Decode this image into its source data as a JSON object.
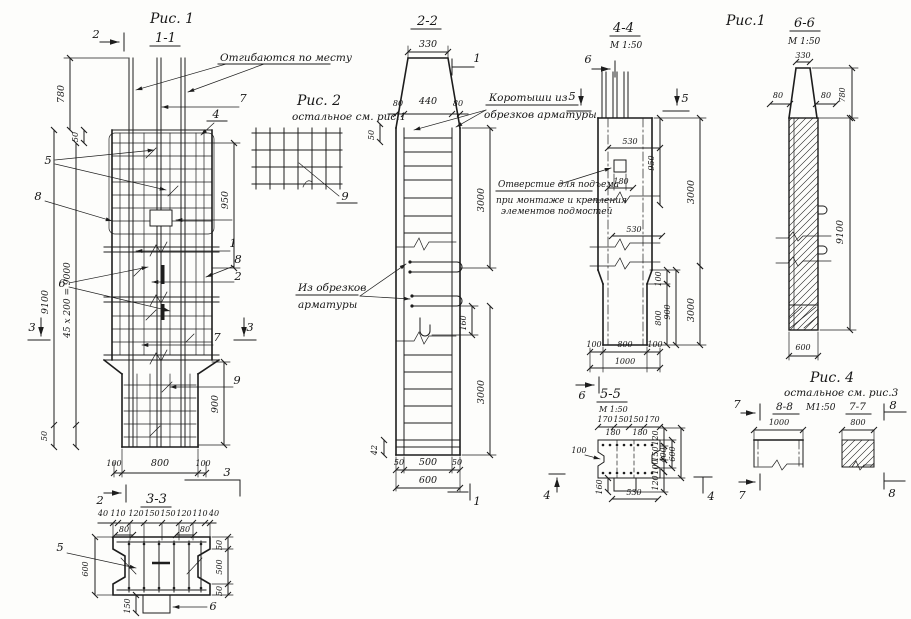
{
  "page": {
    "bg": "#fdfdfb",
    "ink": "#1d1d1d"
  },
  "fig1": {
    "title": "Рис. 1",
    "section": "1-1",
    "m2_top": "2",
    "m2_bottom": "2",
    "note_bend": "Отгибаются по месту",
    "d780": "780",
    "d50_top": "50",
    "d950": "950",
    "d9100": "9100",
    "d45x200": "45 х 200 = 9000",
    "d900": "900",
    "d50_bot": "50",
    "d100l": "100",
    "d800": "800",
    "d100r": "100",
    "c5": "5",
    "c8_left": "8",
    "c6": "6",
    "c1": "1",
    "c8_right": "8",
    "c2_right": "2",
    "c3_left": "3",
    "c3_right": "3",
    "c7_top": "7",
    "c4_top": "4",
    "c7_mid": "7",
    "c9": "9",
    "c3_bottom": "3"
  },
  "fig2": {
    "title": "Рис. 2",
    "subtitle": "остальное см. рис.1",
    "c9": "9"
  },
  "sec22": {
    "title": "2-2",
    "d330": "330",
    "m1_top": "1",
    "d80l": "80",
    "d440": "440",
    "d80r": "80",
    "d50side": "50",
    "note_korotyshi_1": "Коротыши  из",
    "note_korotyshi_2": "обрезков арматуры",
    "d3000a": "3000",
    "d160": "160",
    "d3000b": "3000",
    "note_obrezki_1": "Из обрезков",
    "note_obrezki_2": "арматуры",
    "d42": "42",
    "d50l": "50",
    "d500": "500",
    "d50r": "50",
    "d600": "600",
    "m1_bottom": "1"
  },
  "sec44": {
    "title": "4-4",
    "scale": "М 1:50",
    "fig_label": "Рис.1",
    "m6_top": "6",
    "m5_left": "5",
    "m5_right": "5",
    "d530a": "530",
    "d950": "950",
    "d3000a": "3000",
    "d180": "180",
    "d530b": "530",
    "note_hole_1": "Отверстие для подъема",
    "note_hole_2": "при монтаже и крепления",
    "note_hole_3": "элементов подмостей",
    "d100c": "100",
    "d800v": "800",
    "d900": "900",
    "d3000b": "3000",
    "d100l": "100",
    "d800": "800",
    "d100r": "100",
    "d1000": "1000",
    "m6_bottom": "6"
  },
  "sec55": {
    "title": "5-5",
    "scale": "М 1:50",
    "d170l": "170",
    "d150l": "150",
    "d150r": "150",
    "d170r": "170",
    "d180l": "180",
    "d180r": "180",
    "d100": "100",
    "d120t": "120",
    "d150s": "150",
    "d100s": "100",
    "d400": "400",
    "d600": "600",
    "d120b": "120",
    "d160": "160",
    "d530": "530",
    "m4_left": "4",
    "m4_right": "4"
  },
  "sec66": {
    "title": "6-6",
    "scale": "М 1:50",
    "d330": "330",
    "d80l": "80",
    "d80r": "80",
    "d780": "780",
    "d9100": "9100",
    "d600": "600"
  },
  "sec33": {
    "title": "3-3",
    "top_dims": [
      "40",
      "110",
      "120",
      "150",
      "150",
      "120",
      "110",
      "40"
    ],
    "d80l": "80",
    "d80r": "80",
    "d600": "600",
    "d50t": "50",
    "d500": "500",
    "d50b": "50",
    "d150": "150",
    "c5": "5",
    "c6": "6"
  },
  "fig4": {
    "title": "Рис. 4",
    "subtitle": "остальное см. рис.3",
    "s88": "8-8",
    "scale": "М1:50",
    "s77": "7-7",
    "d1000": "1000",
    "d800": "800",
    "m7_top": "7",
    "m7_bottom": "7",
    "m8_top": "8",
    "m8_bottom": "8"
  }
}
